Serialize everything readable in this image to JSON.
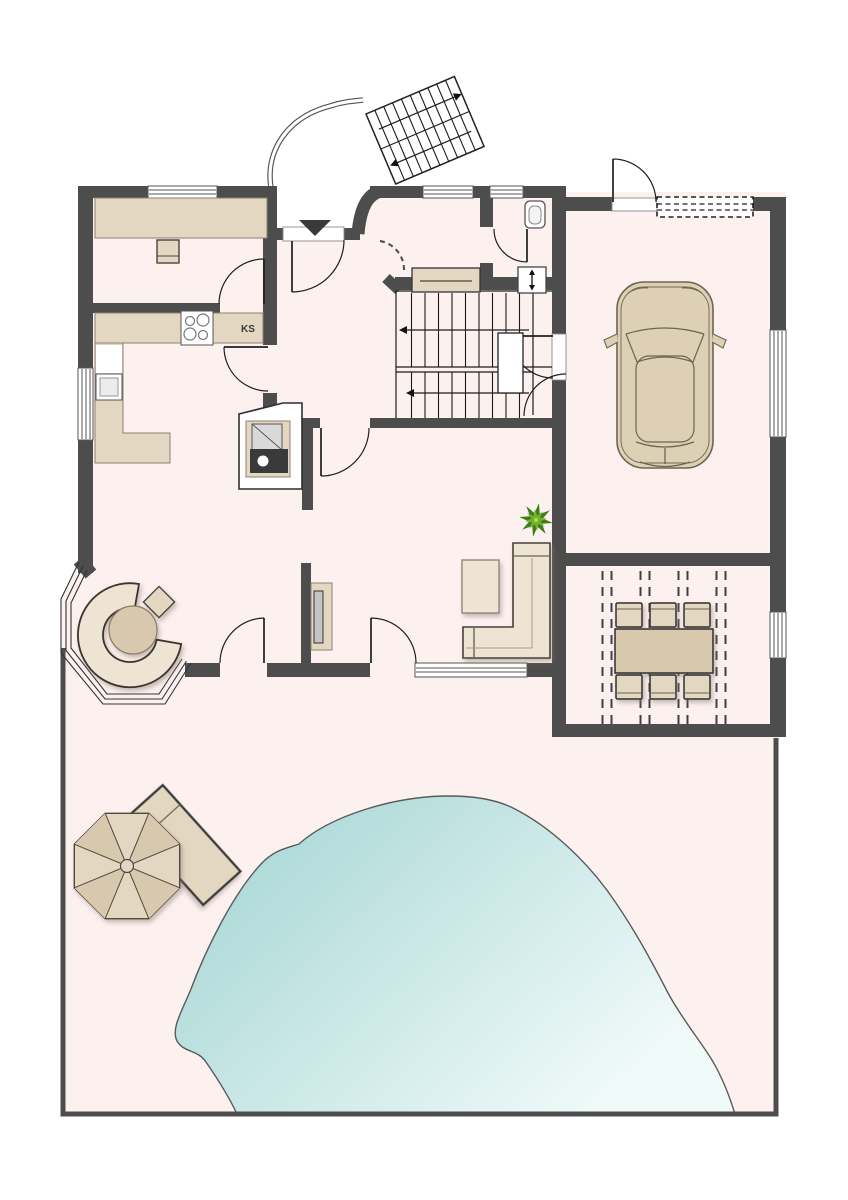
{
  "plan": {
    "labels": {
      "fridge": "KS"
    },
    "colors": {
      "wall": "#4d4d4d",
      "floor": "#fdf1f0",
      "line": "#2e2e2e",
      "furn": "#e4d7c1",
      "furnDark": "#d8c9ae",
      "furnLight": "#eee4d4",
      "pool1": "#9fd3d1",
      "pool2": "#f0faf9",
      "plantDark": "#3f7d1e",
      "plantLight": "#72b32e",
      "screen": "#c4c4c4",
      "carBody": "#ddd0b5",
      "carLine": "#6e6452",
      "fireDark": "#3a3a3a"
    },
    "symbols": [
      "entrance-arrow-icon",
      "stair-direction-arrow-icon",
      "garage-sectional-door-dashed",
      "pergola-beam-dashed",
      "hob-icon",
      "sink-icon",
      "toilet-icon",
      "valve-symbol-icon"
    ]
  }
}
